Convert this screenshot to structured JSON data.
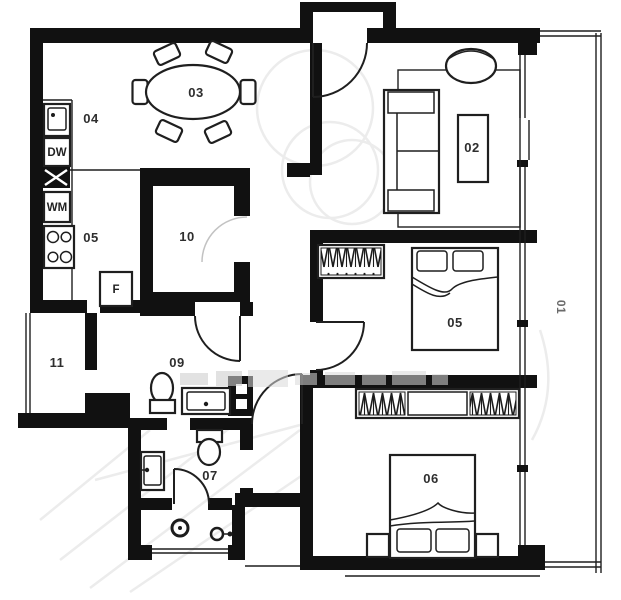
{
  "plan": {
    "type": "apartment-floor-plan",
    "rooms": [
      {
        "id": "balcony",
        "label": "01"
      },
      {
        "id": "living-room",
        "label": "02"
      },
      {
        "id": "dining-area",
        "label": "03"
      },
      {
        "id": "kitchen",
        "label": "04"
      },
      {
        "id": "kitchen-lower",
        "label": "05"
      },
      {
        "id": "bedroom-middle",
        "label": "05"
      },
      {
        "id": "bedroom-bottom",
        "label": "06"
      },
      {
        "id": "bathroom-main",
        "label": "07"
      },
      {
        "id": "bathroom-guest",
        "label": "09"
      },
      {
        "id": "storage-room",
        "label": "10"
      },
      {
        "id": "utility-room",
        "label": "11"
      }
    ],
    "appliances": {
      "dishwasher": "DW",
      "washing_machine": "WM",
      "fridge": "F"
    }
  },
  "colors": {
    "wall": "#111111",
    "line": "#1f1f1f",
    "watermark": "#ececec",
    "background": "#ffffff"
  }
}
